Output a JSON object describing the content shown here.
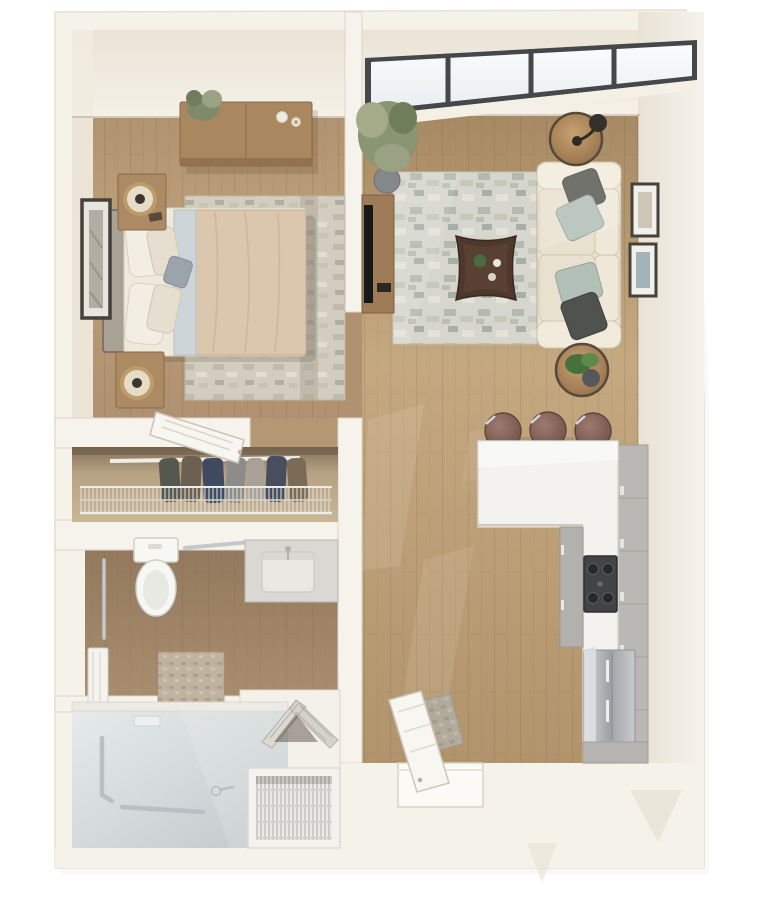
{
  "scene": {
    "kind": "3d-rendered-floor-plan",
    "description": "Top-down 3D floor plan of a one-bedroom, one-bath apartment with open living/kitchen area, walk-in shower, reach-in closet and louvered utility closet",
    "counts": {
      "skylight_panes": 4,
      "bar_stools": 3,
      "sofa_pillows": 4,
      "bed_pillows": 5,
      "living_wall_frames": 2,
      "bedroom_wall_frames": 1,
      "stove_burners": 4,
      "nightstands": 2,
      "table_lamps": 2,
      "side_tables": 2,
      "potted_plants": 3
    }
  },
  "rooms": {
    "bedroom": {
      "items": [
        "bed",
        "upholstered-headboard",
        "duvet",
        "pillows",
        "nightstand",
        "table-lamp",
        "dresser",
        "potted-plant",
        "candles",
        "area-rug",
        "leaning-art-frame",
        "open-door"
      ]
    },
    "living_room": {
      "items": [
        "sofa",
        "throw-pillows",
        "coffee-table",
        "area-rug",
        "round-side-table",
        "black-lamp",
        "plant-side-table",
        "tv-console",
        "tv",
        "potted-plant",
        "skylight-window-band",
        "wall-art"
      ]
    },
    "kitchen": {
      "items": [
        "l-shaped-counter",
        "bar-stools",
        "base-cabinets",
        "tall-cabinets",
        "cooktop",
        "refrigerator"
      ]
    },
    "bathroom": {
      "items": [
        "toilet",
        "grab-bar",
        "vanity-sink",
        "faucet",
        "towel-bar",
        "towel",
        "bath-mat"
      ]
    },
    "shower_room": {
      "items": [
        "walk-in-shower",
        "grab-bars",
        "hand-shower",
        "shower-shelf"
      ]
    },
    "closet": {
      "items": [
        "hanging-clothes",
        "wire-shelf",
        "closet-rod"
      ]
    },
    "utility_closet": {
      "items": [
        "louvered-bifold-doors",
        "wire-shelving-unit"
      ]
    },
    "entry": {
      "items": [
        "entry-door",
        "door-mat",
        "threshold"
      ]
    }
  },
  "palette": {
    "page_bg": "#ffffff",
    "wall": "#f5f2ea",
    "wall_edge": "#e3dccd",
    "wall_face": "#ece6d9",
    "floor_bedroom": "#b39672",
    "floor_living": "#b2946e",
    "floor_bath": "#9d8468",
    "floor_doorway": "#b49874",
    "floor_corner": "#b09270",
    "closet_interior": "#a68f6f",
    "shower_tile": "#d7dcdd",
    "rug_living_base": "#d6d6ce",
    "rug_bedroom_base": "#d3cdc0",
    "window_frame": "#45484b",
    "glass": "#f4f7f6",
    "sofa": "#ece4d2",
    "sofa_arm": "#f2ebdc",
    "seat": "#e9e1cf",
    "pillow_dark": "#55584f",
    "pillow_sage": "#aebdb4",
    "coffee_table": "#4e382c",
    "tv_console": "#9d7c57",
    "tv": "#17181a",
    "pot": "#85888b",
    "plant": "#7e8a6a",
    "headboard": "#a9a193",
    "bed_base": "#efe9dc",
    "duvet": "#dbc7ae",
    "sheet_fold": "#cdd5d9",
    "bed_pillow": "#f2eee3",
    "accent_pillow": "#9aa4aa",
    "nightstand": "#ab8a64",
    "dresser": "#a9875f",
    "lamp_ring": "#bb9c6a",
    "art_frame": "#45413b",
    "art_mat": "#f2f0ea",
    "art_beige": "#cdc6b8",
    "art_blue": "#a3b4b8",
    "counter": "#f3f2ee",
    "cabinet": "#bab8b4",
    "cabinet_inner": "#b3b1ad",
    "stove": "#414346",
    "stool": "#8d6e63",
    "toilet": "#f7f7f4",
    "vanity": "#dad8d2",
    "sink": "#e9e8e3",
    "chrome": "#c3c8cb",
    "towel": "#f4f3ef",
    "mat_bath": "#c0b4a0",
    "mat_entry": "#b2ab9c",
    "door_leaf": "#f8f6f1",
    "louver": "#dbd9d2",
    "wire_alcove": "#f3f2ee",
    "clothes_navy": "#3f4a61",
    "clothes_grey": "#8c8d89",
    "clothes_brown": "#6e6051"
  }
}
